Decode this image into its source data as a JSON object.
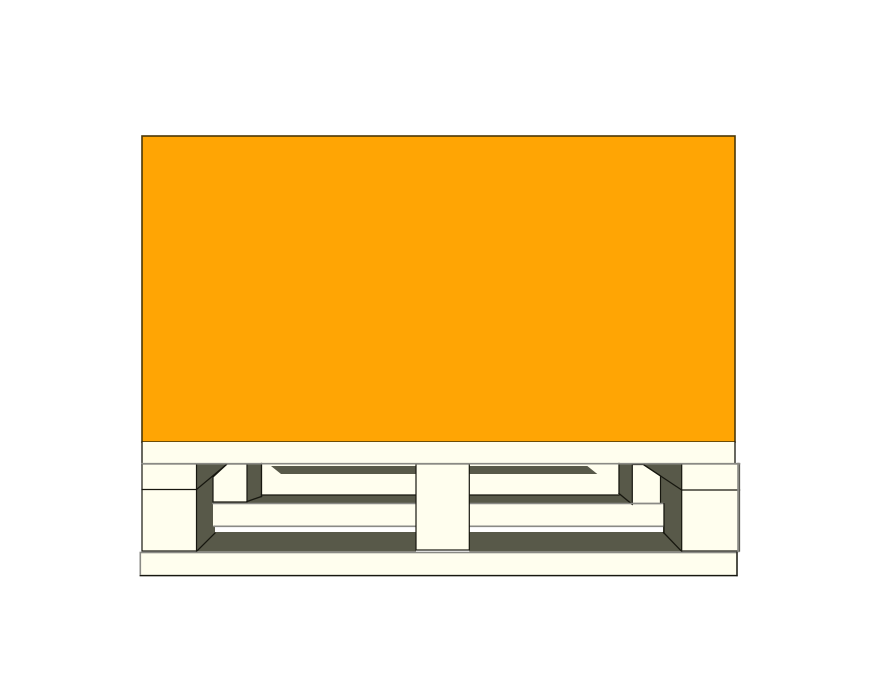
{
  "scene": {
    "description": "3D CAD-style render, front view: an orange cargo box sitting flush on a wooden block pallet against a white background. The pallet shows a cream top lead board, three cream blocks (left, center, right) separated by two dark shadowed fork pockets revealing interior stringer boards and inner blocks in perspective, and a cream bottom lead board.",
    "objects": [
      "cargo-box",
      "top-lead-board",
      "left-block",
      "center-block",
      "right-block",
      "left-fork-pocket",
      "right-fork-pocket",
      "inner-block-left",
      "inner-block-right",
      "interior-stringer-boards",
      "bottom-lead-board"
    ]
  },
  "colors": {
    "background": "#FFFFFF",
    "load_orange": "#FFA504",
    "load_border": "#4A3708",
    "wood_cream": "#FFFEEE",
    "shadow_dark": "#585949",
    "line_black": "#17170F",
    "line_gray": "#8A8A85",
    "gap_white": "#FFFFFF"
  }
}
